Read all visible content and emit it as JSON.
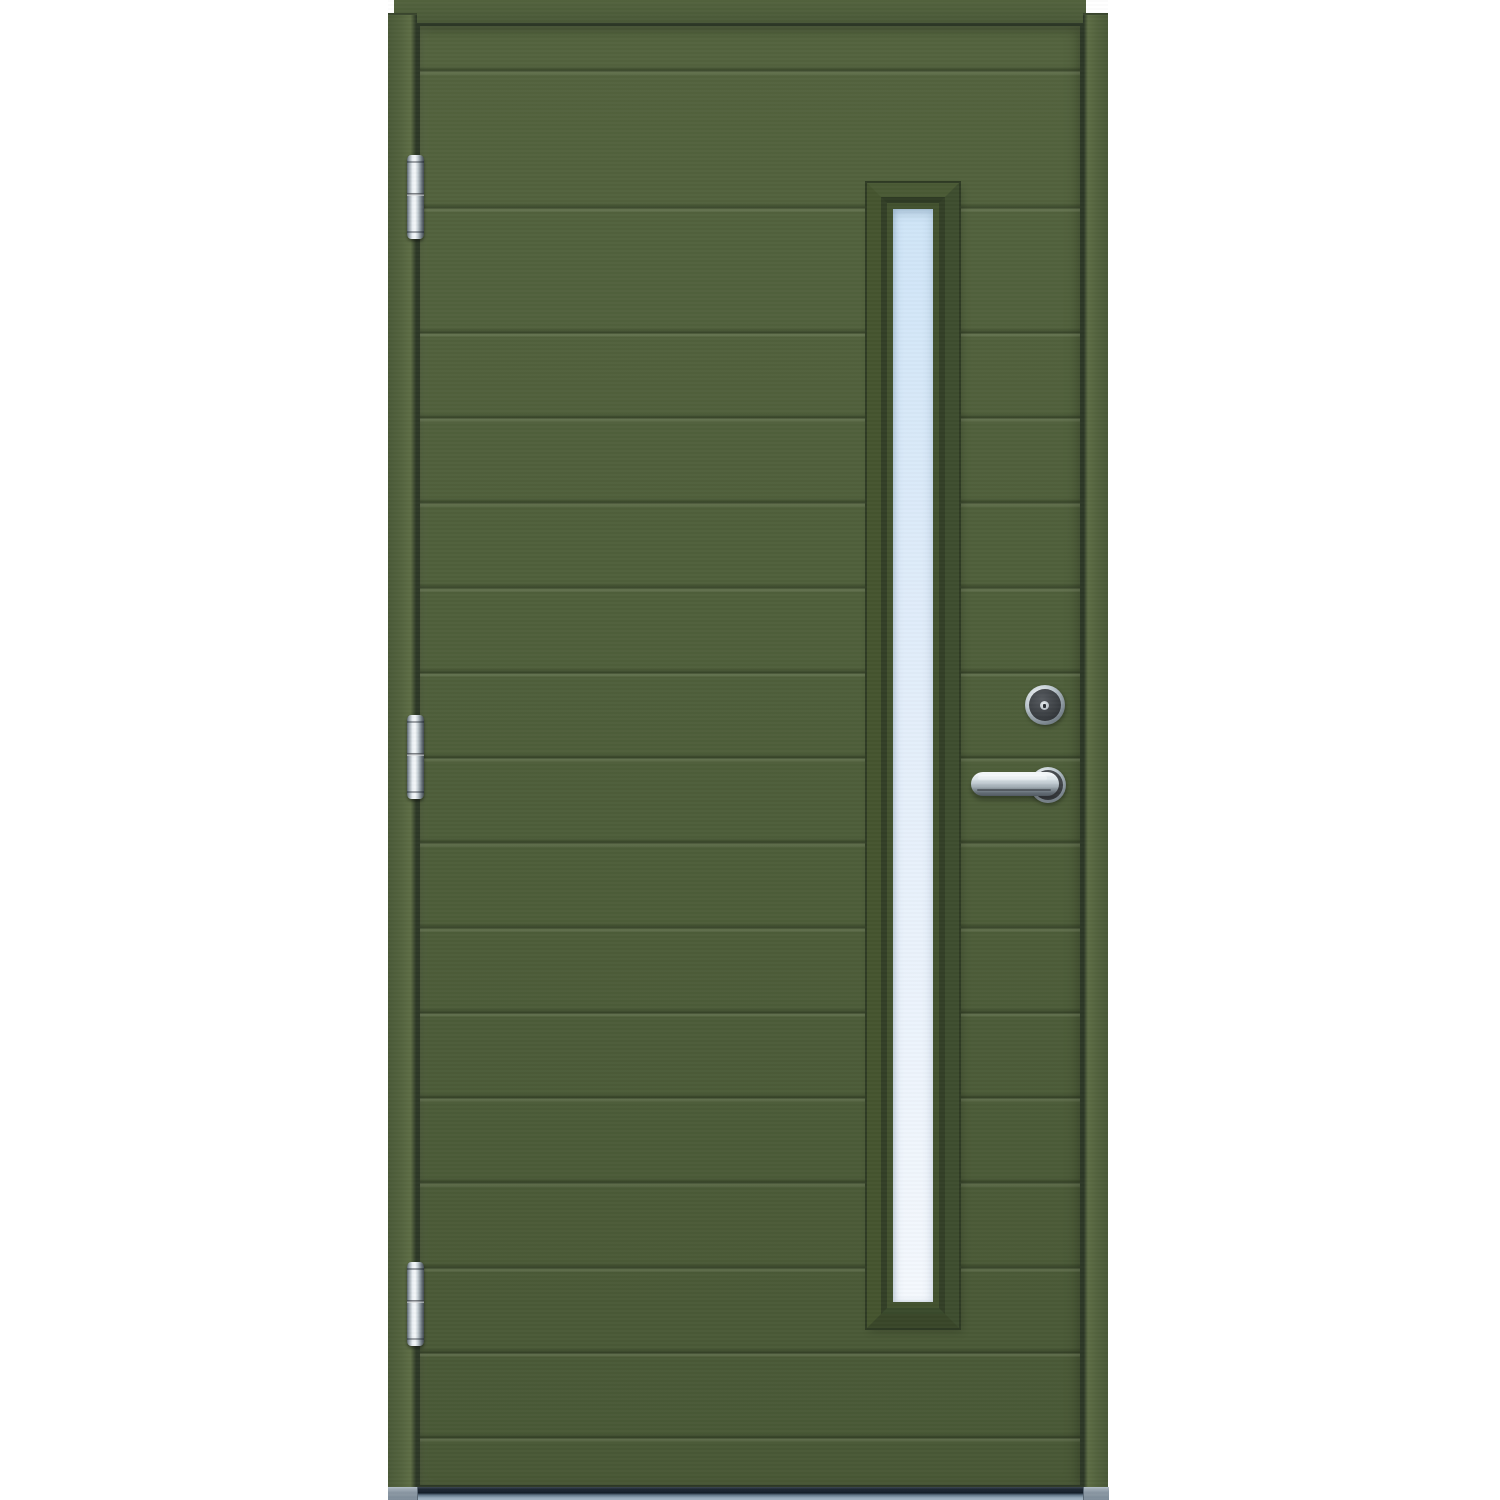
{
  "scene": {
    "description": "Green exterior front door product image on white background",
    "background": "#ffffff"
  },
  "palette": {
    "background": "#ffffff",
    "door_face": "#4f5f3b",
    "door_face_light": "#53633e",
    "door_face_dark": "#495836",
    "frame_green": "#53633e",
    "frame_green_light": "#5d6d45",
    "frame_green_dark": "#4a5938",
    "gap_dark": "#2d3827",
    "joint_line": "#3a462e",
    "trim_green": "#42512f",
    "trim_top": "#4a5a35",
    "trim_right": "#3e4d2f",
    "trim_bottom": "#394629",
    "trim_left": "#45542f",
    "bevel_dark": "#2f3b24",
    "bevel_mid": "#333f27",
    "bevel_light": "#3a4a2c",
    "glass_top": "#cfe5f7",
    "glass_mid": "#e3eefa",
    "glass_bottom": "#f4f8fd",
    "chrome_light": "#f5f8fa",
    "chrome_mid": "#b9c4cb",
    "chrome_dark": "#57616a",
    "lock_face": "#3a3e42",
    "rose_face": "#45494d",
    "sill_dark": "#1b2531",
    "sill_light": "#93a6b7"
  },
  "door": {
    "board_count": 15,
    "groove_positions_y": [
      70,
      207,
      332,
      417,
      502,
      587,
      672,
      757,
      842,
      927,
      1012,
      1097,
      1182,
      1267,
      1352,
      1437
    ]
  },
  "window": {
    "shape": "tall-narrow-rectangle",
    "glazing": "clear"
  },
  "hinges": {
    "count": 3,
    "finish": "chrome",
    "positions_y": [
      155,
      715,
      1262
    ]
  },
  "lock": {
    "finish": "chrome",
    "type": "cylinder-escutcheon"
  },
  "handle": {
    "finish": "chrome",
    "type": "lever-on-round-rose"
  },
  "threshold": {
    "finish": "metallic-gray"
  }
}
